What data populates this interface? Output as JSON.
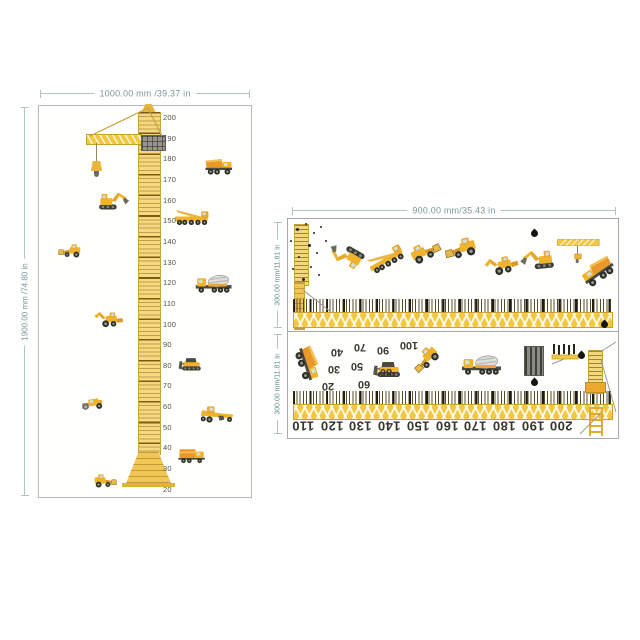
{
  "left_chart": {
    "width_label": "1000.00 mm /39.37 in",
    "height_label": "1900.00 mm /74.80 in",
    "ruler_numbers": [
      "200",
      "190",
      "180",
      "170",
      "160",
      "150",
      "140",
      "130",
      "120",
      "110",
      "100",
      "90",
      "80",
      "70",
      "60",
      "50",
      "40",
      "30",
      "20"
    ],
    "ruler_numbers_start_y": 117,
    "ruler_numbers_step": 20.65,
    "ruler_numbers_x": 163,
    "vehicles": [
      {
        "type": "dump-truck",
        "x": 220,
        "y": 167,
        "w": 37,
        "rot": 0,
        "flip": false
      },
      {
        "type": "excavator",
        "x": 111,
        "y": 199,
        "w": 40,
        "rot": 0,
        "flip": false
      },
      {
        "type": "crane-truck",
        "x": 192,
        "y": 217,
        "w": 42,
        "rot": 0,
        "flip": false
      },
      {
        "type": "wheel-loader",
        "x": 71,
        "y": 251,
        "w": 31,
        "rot": 0,
        "flip": false
      },
      {
        "type": "mixer",
        "x": 215,
        "y": 284,
        "w": 44,
        "rot": 0,
        "flip": false
      },
      {
        "type": "backhoe",
        "x": 109,
        "y": 319,
        "w": 36,
        "rot": 0,
        "flip": true
      },
      {
        "type": "bulldozer",
        "x": 192,
        "y": 364,
        "w": 33,
        "rot": 0,
        "flip": false
      },
      {
        "type": "roller",
        "x": 94,
        "y": 404,
        "w": 31,
        "rot": -8,
        "flip": false
      },
      {
        "type": "grader",
        "x": 217,
        "y": 414,
        "w": 40,
        "rot": 0,
        "flip": true
      },
      {
        "type": "truck",
        "x": 194,
        "y": 456,
        "w": 37,
        "rot": 0,
        "flip": false
      },
      {
        "type": "wheel-loader",
        "x": 103,
        "y": 481,
        "w": 31,
        "rot": 0,
        "flip": true
      }
    ]
  },
  "right_sheet": {
    "width_label": "900.00 mm/35.43 in",
    "strip1": {
      "height_label": "300.00 mm/11.81 in",
      "vehicles": [
        {
          "type": "excavator",
          "x": 348,
          "y": 258,
          "w": 46,
          "rot": 210,
          "flip": false
        },
        {
          "type": "crane-truck",
          "x": 386,
          "y": 258,
          "w": 46,
          "rot": -30,
          "flip": false
        },
        {
          "type": "wheel-loader",
          "x": 423,
          "y": 252,
          "w": 42,
          "rot": -25,
          "flip": true
        },
        {
          "type": "wheel-loader",
          "x": 463,
          "y": 248,
          "w": 44,
          "rot": -15,
          "flip": false
        },
        {
          "type": "backhoe",
          "x": 502,
          "y": 265,
          "w": 42,
          "rot": -12,
          "flip": true
        },
        {
          "type": "excavator",
          "x": 540,
          "y": 258,
          "w": 44,
          "rot": -6,
          "flip": true
        },
        {
          "type": "jib",
          "x": 579,
          "y": 250,
          "w": 46,
          "rot": 0,
          "flip": false
        },
        {
          "type": "dump-truck",
          "x": 596,
          "y": 272,
          "w": 46,
          "rot": -35,
          "flip": true
        }
      ],
      "specks": [
        [
          296,
          228,
          3
        ],
        [
          305,
          223,
          2
        ],
        [
          313,
          232,
          2
        ],
        [
          290,
          240,
          2
        ],
        [
          308,
          244,
          3
        ],
        [
          298,
          256,
          2
        ],
        [
          316,
          252,
          2
        ],
        [
          292,
          268,
          2
        ],
        [
          310,
          266,
          2
        ],
        [
          302,
          278,
          3
        ],
        [
          318,
          274,
          2
        ],
        [
          325,
          240,
          2
        ],
        [
          320,
          226,
          2
        ]
      ],
      "droplets": [
        [
          531,
          230
        ],
        [
          601,
          321
        ]
      ]
    },
    "strip2": {
      "height_label": "300.00 mm/11.81 in",
      "scale_numbers": [
        "110",
        "120",
        "130",
        "140",
        "150",
        "160",
        "170",
        "180",
        "190",
        "200"
      ],
      "scale_numbers_start_x": 303,
      "scale_numbers_step": 28.7,
      "scale_numbers_y": 426,
      "scatter_numbers": [
        {
          "t": "40",
          "x": 337,
          "y": 352
        },
        {
          "t": "70",
          "x": 360,
          "y": 347
        },
        {
          "t": "90",
          "x": 383,
          "y": 350
        },
        {
          "t": "100",
          "x": 409,
          "y": 345
        },
        {
          "t": "30",
          "x": 334,
          "y": 369
        },
        {
          "t": "50",
          "x": 357,
          "y": 366
        },
        {
          "t": "80",
          "x": 386,
          "y": 372
        },
        {
          "t": "20",
          "x": 328,
          "y": 386
        },
        {
          "t": "60",
          "x": 364,
          "y": 384
        }
      ],
      "vehicles": [
        {
          "type": "dump-truck",
          "x": 309,
          "y": 365,
          "w": 46,
          "rot": 72,
          "flip": false
        },
        {
          "type": "bulldozer",
          "x": 390,
          "y": 369,
          "w": 40,
          "rot": 0,
          "flip": false
        },
        {
          "type": "wheel-loader",
          "x": 427,
          "y": 357,
          "w": 40,
          "rot": -45,
          "flip": false
        },
        {
          "type": "mixer",
          "x": 483,
          "y": 365,
          "w": 48,
          "rot": 0,
          "flip": false
        }
      ],
      "droplets": [
        [
          578,
          352
        ],
        [
          531,
          379
        ]
      ]
    }
  },
  "colors": {
    "vehicle_yellow": "#f0b42c",
    "vehicle_orange": "#e8992a",
    "ruler_yellow": "#f2c843",
    "tick_dark": "#1d1c14",
    "dimension_text": "#7c9797",
    "number_text": "#35352c"
  },
  "icons": {
    "droplet": "black teardrop mark",
    "vehicle_set": [
      "excavator-icon",
      "dump-truck-icon",
      "wheel-loader-icon",
      "crane-truck-icon",
      "mixer-truck-icon",
      "bulldozer-icon",
      "roller-icon",
      "grader-icon",
      "box-truck-icon",
      "backhoe-icon",
      "crane-jib-icon",
      "tower-crane-icon"
    ]
  }
}
